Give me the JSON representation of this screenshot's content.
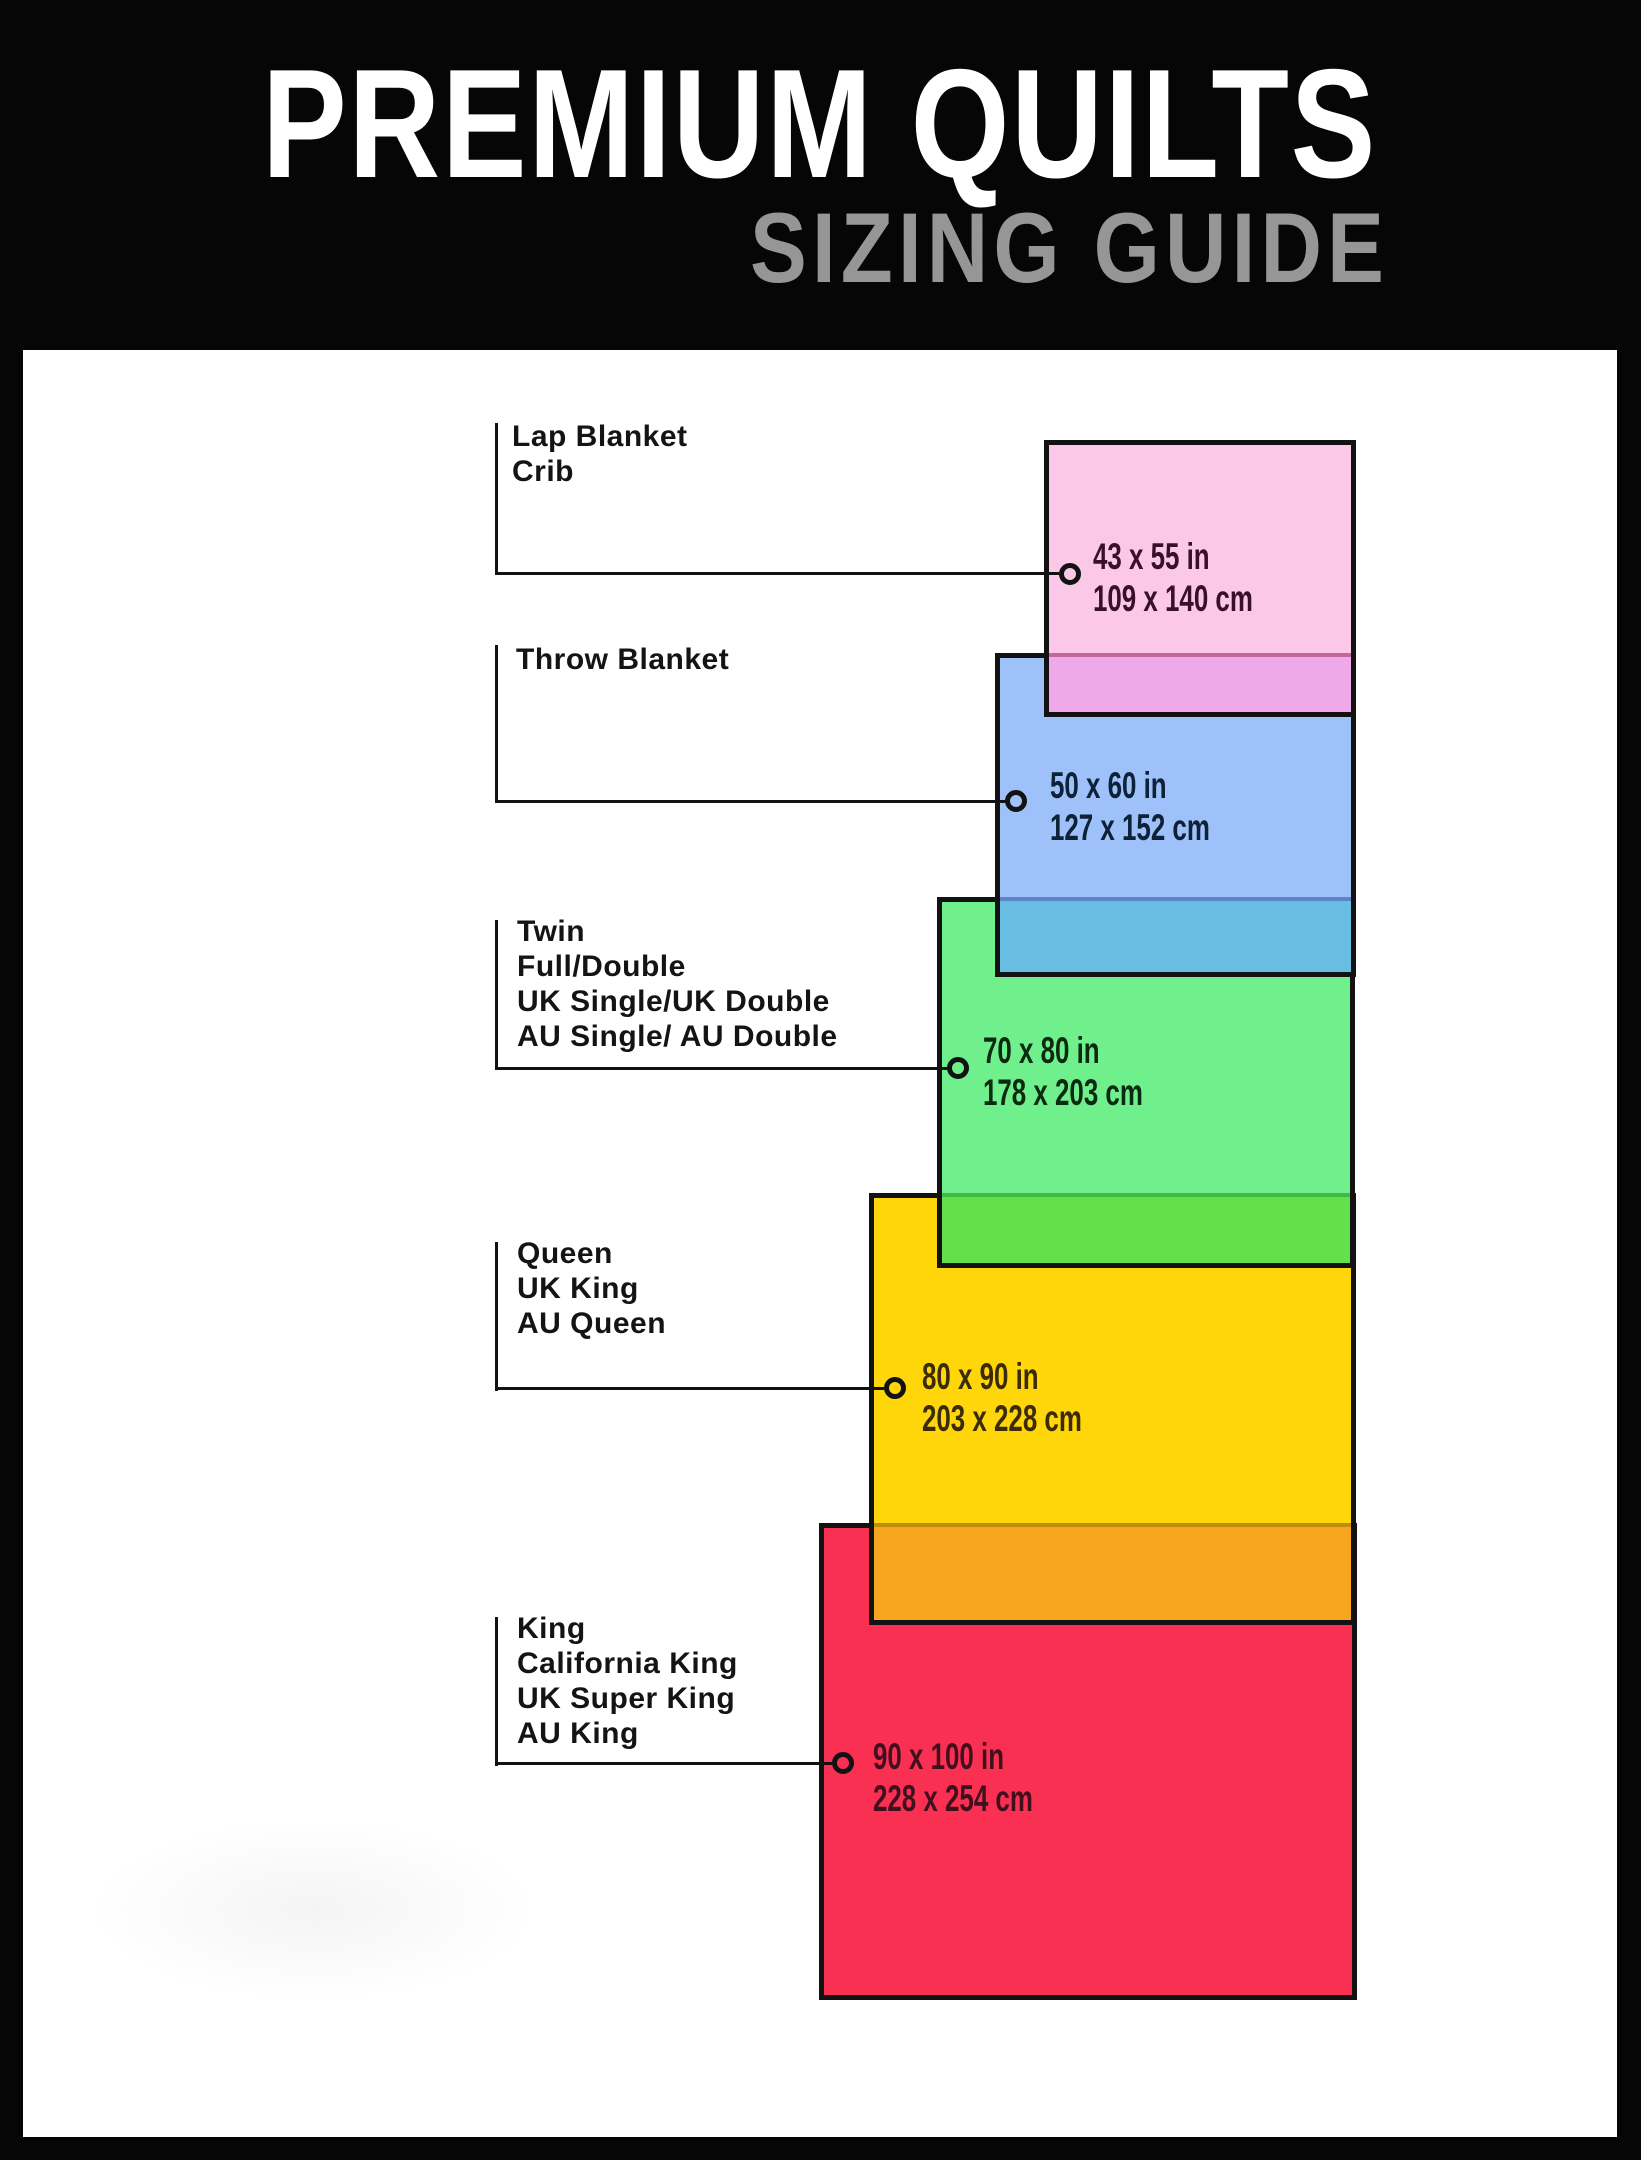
{
  "header": {
    "title": "PREMIUM QUILTS",
    "subtitle": "SIZING GUIDE"
  },
  "colors": {
    "bg": "#060606",
    "panel": "#ffffff",
    "ink": "#121212",
    "title": "#ffffff",
    "subtitle": "#969696"
  },
  "sizes": [
    {
      "labels": [
        "Lap Blanket",
        "Crib"
      ],
      "imperial": "43 x 55 in",
      "metric": "109 x 140 cm",
      "colors": {
        "fill": "#fbc9e7",
        "overlap": "#f0a9e8",
        "divider": "#c2679e",
        "text": "#38102c"
      }
    },
    {
      "labels": [
        "Throw Blanket"
      ],
      "imperial": "50 x 60 in",
      "metric": "127 x 152 cm",
      "colors": {
        "fill": "#9ec1fa",
        "overlap": "#68bde2",
        "divider": "#5b85c8",
        "text": "#0d2137"
      }
    },
    {
      "labels": [
        "Twin",
        "Full/Double",
        "UK Single/UK Double",
        "AU Single/ AU Double"
      ],
      "imperial": "70 x 80 in",
      "metric": "178 x 203 cm",
      "colors": {
        "fill": "#6ff08c",
        "overlap": "#63e14c",
        "divider": "#41b944",
        "text": "#0c2a12"
      }
    },
    {
      "labels": [
        "Queen",
        "UK King",
        "AU Queen"
      ],
      "imperial": "80 x 90 in",
      "metric": "203 x 228 cm",
      "colors": {
        "fill": "#ffd60a",
        "overlap": "#f7a51e",
        "divider": "#bf8d10",
        "text": "#3b2b06"
      }
    },
    {
      "labels": [
        "King",
        "California King",
        "UK Super King",
        "AU King"
      ],
      "imperial": "90 x 100 in",
      "metric": "228 x 254 cm",
      "colors": {
        "fill": "#fa3053",
        "text": "#40101e"
      }
    }
  ]
}
